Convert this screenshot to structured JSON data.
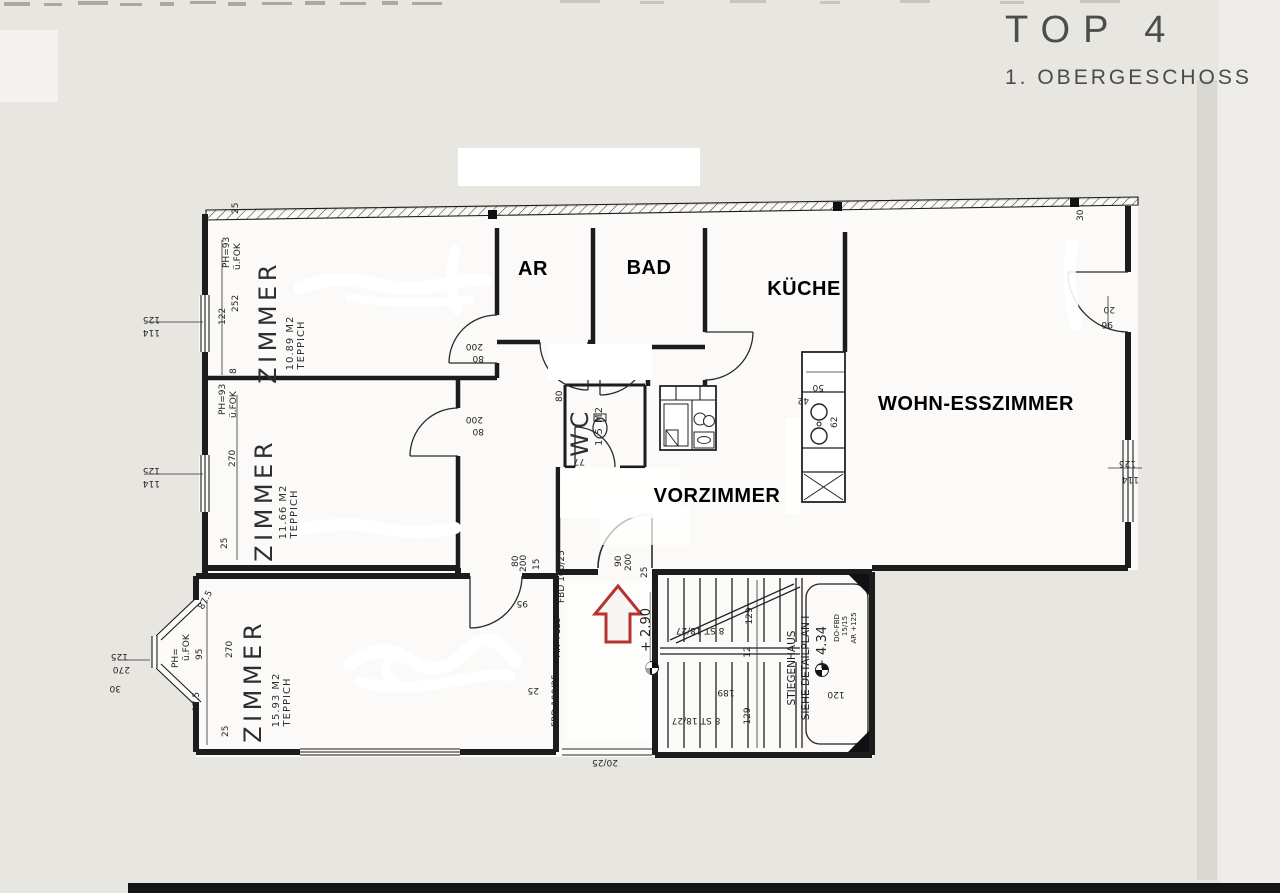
{
  "header": {
    "title": "TOP 4",
    "subtitle": "1. OBERGESCHOSS"
  },
  "colors": {
    "paper": "#e8e6e1",
    "line": "#1c1c1c",
    "arrow_red": "#b63430"
  },
  "rooms": {
    "zimmer1": {
      "name": "ZIMMER",
      "area": "10.89 M2",
      "floor": "TEPPICH"
    },
    "zimmer2": {
      "name": "ZIMMER",
      "area": "11.66 M2",
      "floor": "TEPPICH"
    },
    "zimmer3": {
      "name": "ZIMMER",
      "area": "15.93 M2",
      "floor": "TEPPICH"
    },
    "ar": {
      "name": "AR"
    },
    "bad": {
      "name": "BAD"
    },
    "kueche": {
      "name": "KÜCHE"
    },
    "wohnesszimmer": {
      "name": "WOHN-ESSZIMMER"
    },
    "vorzimmer": {
      "name": "VORZIMMER"
    },
    "wc": {
      "name": "WC",
      "area": "1.5 M2"
    }
  },
  "stairwell": {
    "label_line1": "STIEGENHAUS",
    "label_line2": "SIEHE DETAILPLAN I",
    "level_upper": "+ 4.34",
    "level_lower": "+ 2.90",
    "note1": "DO-FBD",
    "note2": "15/15",
    "note3": "AR +125",
    "flight1": "8 ST 18/27",
    "flight2": "8 ST 18/27",
    "dims": [
      "129",
      "12",
      "189",
      "129",
      "120"
    ]
  },
  "dims": [
    "125",
    "114",
    "122",
    "252",
    "PH=93",
    "ü.FOK",
    "8",
    "125",
    "114",
    "PH=93",
    "ü.FOK",
    "270",
    "25",
    "87.5",
    "PH=",
    "ü.FOK",
    "95",
    "270",
    "87.5",
    "25",
    "125",
    "270",
    "30",
    "200",
    "80",
    "200",
    "80",
    "80",
    "90",
    "200",
    "25",
    "80",
    "200",
    "15",
    "95",
    "FBD 100/25",
    "AR +125",
    "FBD 100/25",
    "25",
    "50",
    "42",
    "62",
    "20",
    "96",
    "125",
    "114",
    "25",
    "30",
    "77",
    "20/25"
  ]
}
